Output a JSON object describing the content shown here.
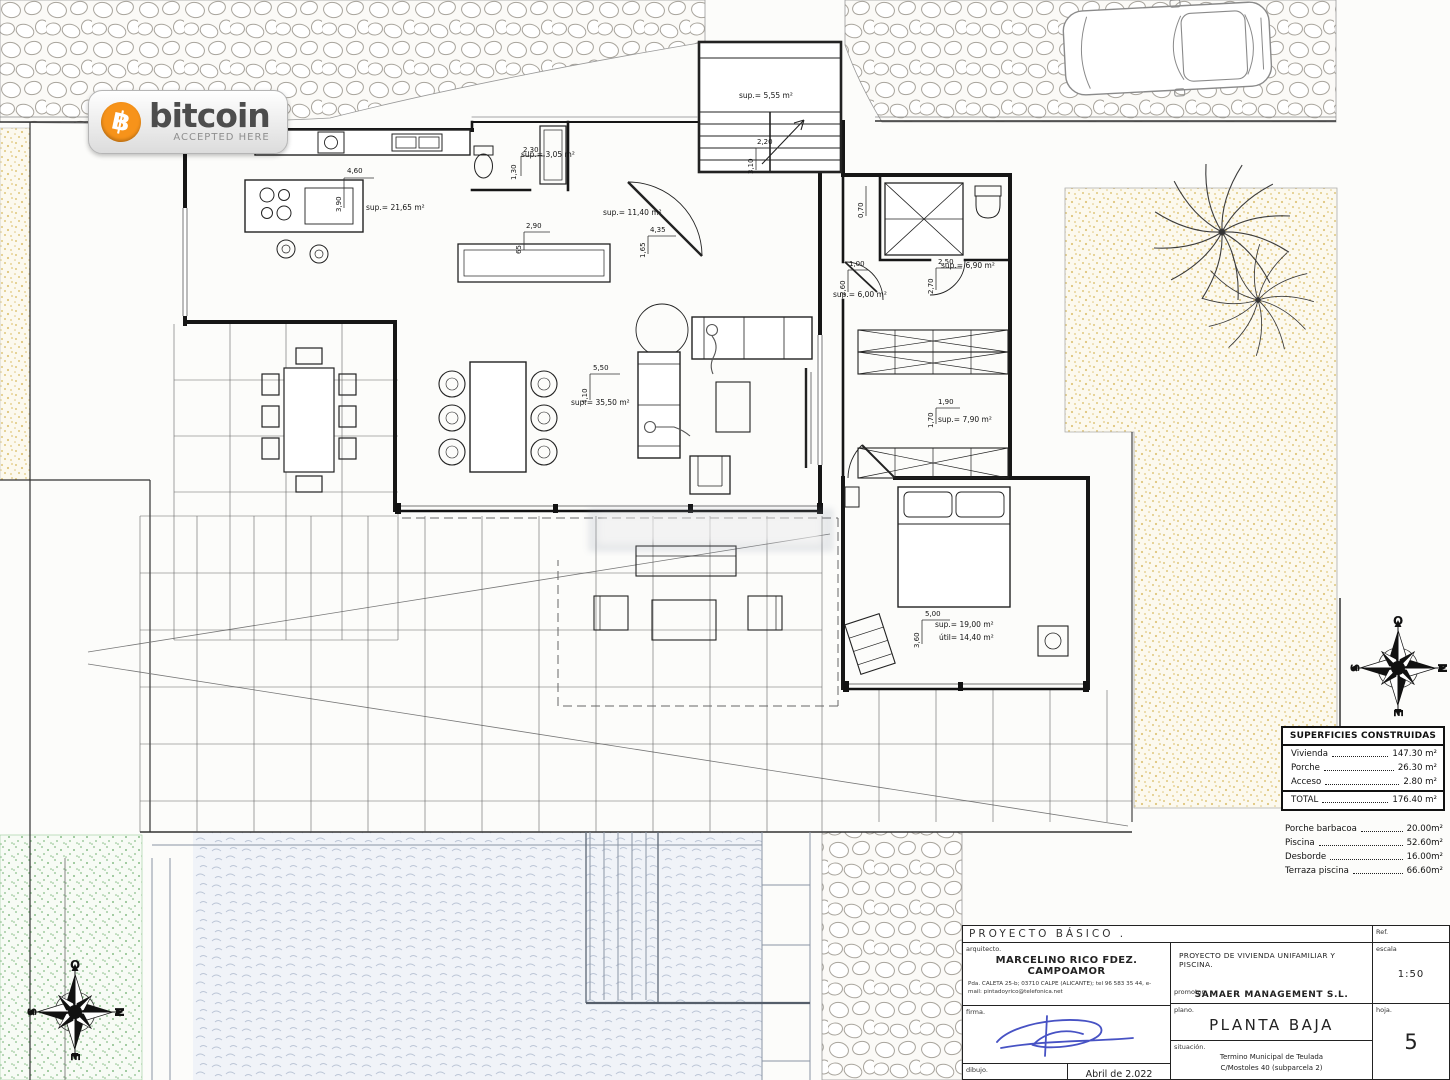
{
  "badge": {
    "brand": "bitcoin",
    "tagline": "ACCEPTED HERE",
    "symbol": "฿",
    "orange": "#f7931a"
  },
  "compass": {
    "top": "O",
    "right": "N",
    "bottom": "E",
    "left": "S"
  },
  "plan": {
    "area_labels": [
      {
        "text": "sup.= 21,65 m²"
      },
      {
        "text": "sup.= 3,05 m²"
      },
      {
        "text": "sup.= 11,40 m²"
      },
      {
        "text": "sup.= 5,55 m²"
      },
      {
        "text": "sup.= 35,50 m²"
      },
      {
        "text": "sup.= 6,00 m²"
      },
      {
        "text": "sup.= 6,90 m²"
      },
      {
        "text": "sup.= 7,90 m²"
      },
      {
        "text": "sup.= 19,00 m²"
      },
      {
        "text": "útil= 14,40 m²"
      }
    ],
    "dim_labels": [
      {
        "text": "4,60"
      },
      {
        "text": "3,90"
      },
      {
        "text": "2,30"
      },
      {
        "text": "1,30"
      },
      {
        "text": "2,90"
      },
      {
        "text": "65"
      },
      {
        "text": "4,35"
      },
      {
        "text": "1,65"
      },
      {
        "text": "2,20"
      },
      {
        "text": "3,10"
      },
      {
        "text": "5,50"
      },
      {
        "text": "4,10"
      },
      {
        "text": "1,00"
      },
      {
        "text": "2,60"
      },
      {
        "text": "2,50"
      },
      {
        "text": "2,70"
      },
      {
        "text": "1,90"
      },
      {
        "text": "1,70"
      },
      {
        "text": "5,00"
      },
      {
        "text": "3,60"
      },
      {
        "text": "0,70"
      }
    ]
  },
  "surfaces_panel": {
    "title": "SUPERFICIES CONSTRUIDAS",
    "rows": [
      {
        "label": "Vivienda",
        "value": "147.30 m²"
      },
      {
        "label": "Porche",
        "value": "26.30 m²"
      },
      {
        "label": "Acceso",
        "value": "2.80 m²"
      }
    ],
    "total": {
      "label": "TOTAL",
      "value": "176.40 m²"
    },
    "extras": [
      {
        "label": "Porche barbacoa",
        "value": "20.00m²"
      },
      {
        "label": "Piscina",
        "value": "52.60m²"
      },
      {
        "label": "Desborde",
        "value": "16.00m²"
      },
      {
        "label": "Terraza piscina",
        "value": "66.60m²"
      }
    ]
  },
  "title_block": {
    "header": "PROYECTO  BÁSICO  .",
    "ref_label": "Ref.",
    "arquitecto_label": "arquitecto.",
    "arquitecto_name": "MARCELINO RICO FDEZ. CAMPOAMOR",
    "arquitecto_address": "Pda. CALETA 25-b; 03710 CALPE (ALICANTE); tel 96 583 35 44, e-mail: pintadoyrico@telefonica.net",
    "firma_label": "firma.",
    "dibujo_label": "dibujo.",
    "date": "Abril de 2.022",
    "project_title": "PROYECTO DE VIVIENDA UNIFAMILIAR Y PISCINA.",
    "promotor_label": "promotor.",
    "promotor_name": "SAMAER MANAGEMENT S.L.",
    "plano_label": "plano.",
    "plano_value": "PLANTA  BAJA",
    "situacion_label": "situación.",
    "situacion_line1": "Termino Municipal de Teulada",
    "situacion_line2": "C/Mostoles 40 (subparcela 2)",
    "escala_label": "escala",
    "escala_value": "1:50",
    "hoja_label": "hoja.",
    "hoja_value": "5"
  }
}
